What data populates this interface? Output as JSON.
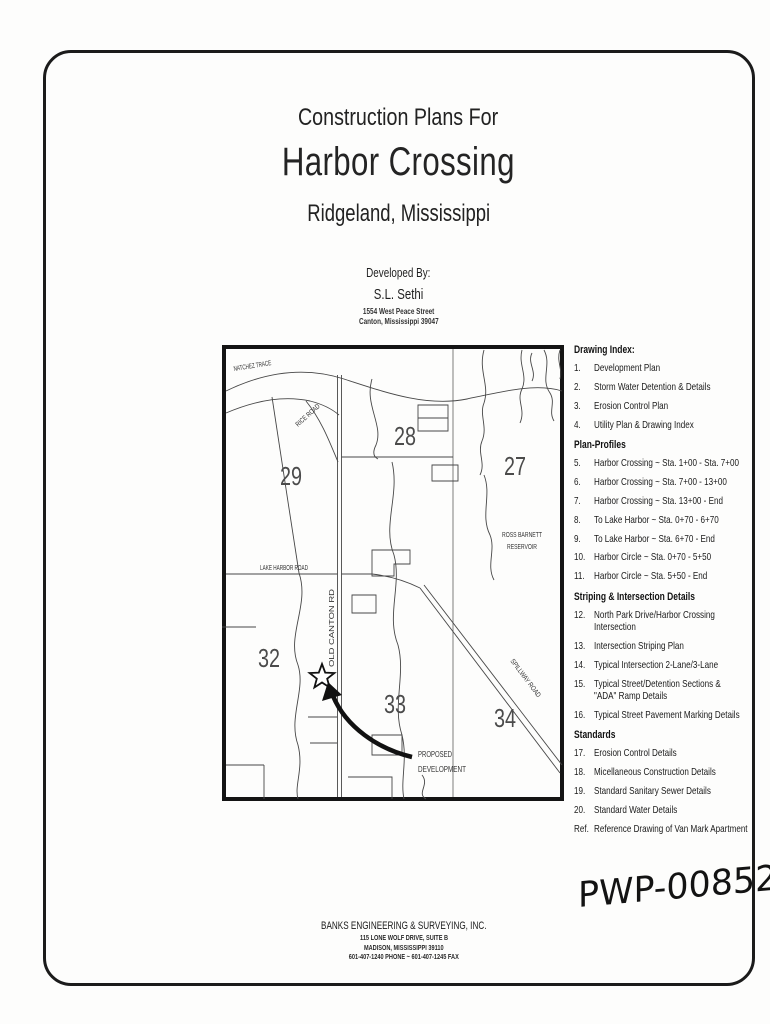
{
  "title_block": {
    "line1": "Construction Plans For",
    "line2": "Harbor Crossing",
    "line3": "Ridgeland, Mississippi"
  },
  "developer_block": {
    "heading": "Developed By:",
    "name": "S.L. Sethi",
    "address1": "1554 West Peace Street",
    "address2": "Canton, Mississippi 39047"
  },
  "map": {
    "labels": {
      "natchez_trace": "NATCHEZ TRACE",
      "rice_road": "RICE ROAD",
      "ross_barnett_1": "ROSS BARNETT",
      "ross_barnett_2": "RESERVOIR",
      "lake_harbor_road": "LAKE HARBOR ROAD",
      "old_canton_rd": "OLD CANTON RD",
      "spillway_road": "SPILLWAY ROAD",
      "proposed_1": "PROPOSED",
      "proposed_2": "DEVELOPMENT"
    },
    "sections": {
      "s29": "29",
      "s28": "28",
      "s27": "27",
      "s32": "32",
      "s33": "33",
      "s34": "34"
    }
  },
  "drawing_index": {
    "entries": [
      {
        "type": "heading",
        "text": "Drawing Index:"
      },
      {
        "type": "item",
        "num": "1.",
        "text": "Development Plan"
      },
      {
        "type": "item",
        "num": "2.",
        "text": "Storm Water Detention & Details"
      },
      {
        "type": "item",
        "num": "3.",
        "text": "Erosion Control Plan"
      },
      {
        "type": "item",
        "num": "4.",
        "text": "Utility Plan & Drawing Index"
      },
      {
        "type": "heading",
        "text": "Plan-Profiles"
      },
      {
        "type": "item",
        "num": "5.",
        "text": "Harbor Crossing ~ Sta. 1+00 - Sta. 7+00"
      },
      {
        "type": "item",
        "num": "6.",
        "text": "Harbor Crossing ~ Sta. 7+00 - 13+00"
      },
      {
        "type": "item",
        "num": "7.",
        "text": "Harbor Crossing ~ Sta. 13+00 - End"
      },
      {
        "type": "item",
        "num": "8.",
        "text": "To Lake Harbor ~ Sta. 0+70 - 6+70"
      },
      {
        "type": "item",
        "num": "9.",
        "text": "To Lake Harbor ~ Sta. 6+70 - End"
      },
      {
        "type": "item",
        "num": "10.",
        "text": "Harbor Circle ~ Sta. 0+70 - 5+50"
      },
      {
        "type": "item",
        "num": "11.",
        "text": "Harbor Circle ~ Sta. 5+50 - End"
      },
      {
        "type": "heading",
        "text": "Striping & Intersection Details"
      },
      {
        "type": "item",
        "num": "12.",
        "text": "North Park Drive/Harbor Crossing Intersection"
      },
      {
        "type": "item",
        "num": "13.",
        "text": "Intersection Striping Plan"
      },
      {
        "type": "item",
        "num": "14.",
        "text": "Typical Intersection 2-Lane/3-Lane"
      },
      {
        "type": "item",
        "num": "15.",
        "text": "Typical Street/Detention Sections &",
        "text2": "\"ADA\" Ramp Details"
      },
      {
        "type": "item",
        "num": "16.",
        "text": "Typical Street Pavement Marking Details"
      },
      {
        "type": "heading",
        "text": "Standards"
      },
      {
        "type": "item",
        "num": "17.",
        "text": "Erosion Control Details"
      },
      {
        "type": "item",
        "num": "18.",
        "text": "Micellaneous Construction Details"
      },
      {
        "type": "item",
        "num": "19.",
        "text": "Standard Sanitary Sewer Details"
      },
      {
        "type": "item",
        "num": "20.",
        "text": "Standard Water Details"
      },
      {
        "type": "item",
        "num": "Ref.",
        "text": "Reference Drawing of Van Mark Apartment"
      }
    ]
  },
  "footer": {
    "company": "BANKS ENGINEERING & SURVEYING, INC.",
    "address1": "115 LONE WOLF DRIVE, SUITE B",
    "address2": "MADISON, MISSISSIPPI 39110",
    "phone": "601-407-1240 PHONE ~ 601-407-1245 FAX"
  },
  "stamp": {
    "pwp_number": "PWP-00852"
  }
}
